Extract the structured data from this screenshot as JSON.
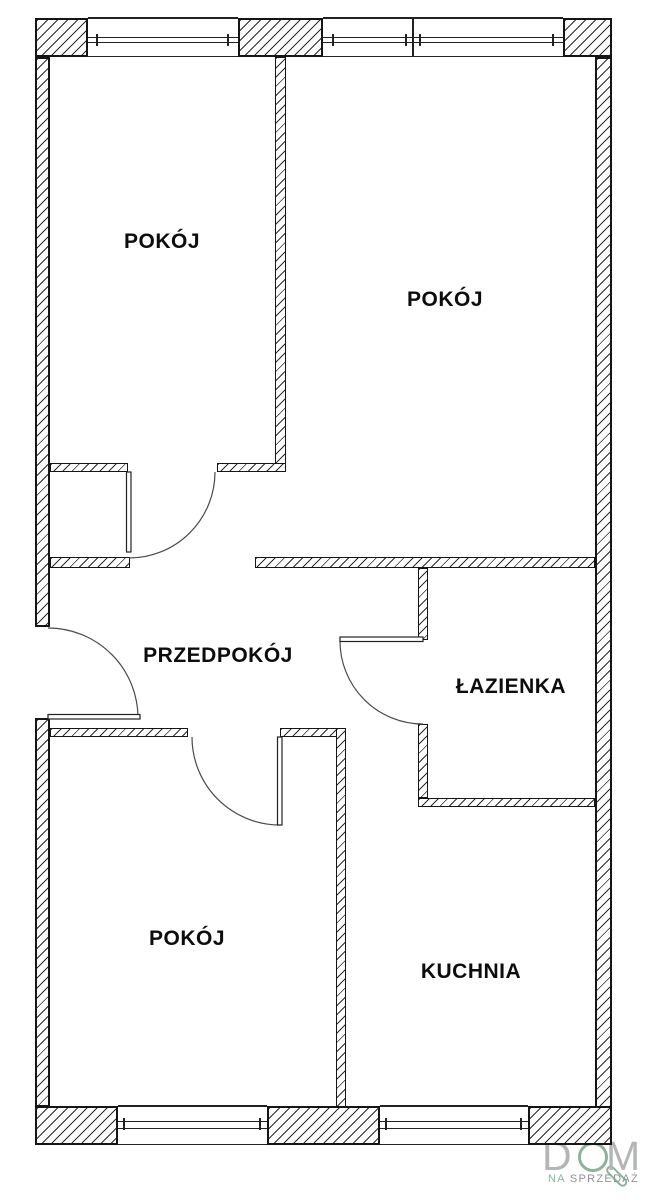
{
  "rooms": [
    {
      "id": "pokoj-top-left",
      "label": "POKÓJ"
    },
    {
      "id": "pokoj-top-right",
      "label": "POKÓJ"
    },
    {
      "id": "przedpokoj",
      "label": "PRZEDPOKÓJ"
    },
    {
      "id": "lazienka",
      "label": "ŁAZIENKA"
    },
    {
      "id": "pokoj-bottom-left",
      "label": "POKÓJ"
    },
    {
      "id": "kuchnia",
      "label": "KUCHNIA"
    }
  ],
  "logo": {
    "letter_d": "D",
    "letter_m": "M",
    "tagline_na": "NA",
    "tagline_sprzedaz": "SPRZEDAŻ"
  },
  "colors": {
    "wall_line": "#151515",
    "logo_green": "#8bb49a",
    "logo_letter_gray": "#b4b5b7",
    "logo_tagline_gray": "#8f9193"
  }
}
